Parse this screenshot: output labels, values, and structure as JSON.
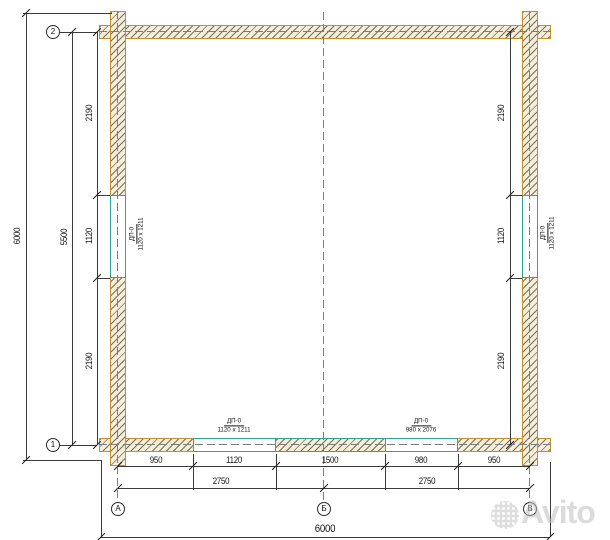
{
  "drawing": {
    "axes": {
      "row_top": "2",
      "row_bottom": "1",
      "col_a": "А",
      "col_b": "Б",
      "col_c": "В"
    },
    "dimensions": {
      "overall_height": "6000",
      "axis_height": "5500",
      "left_segments": [
        "2190",
        "1120",
        "2190"
      ],
      "right_segments": [
        "2190",
        "1120",
        "2190"
      ],
      "bottom_segments": [
        "950",
        "1120",
        "1500",
        "980",
        "950"
      ],
      "bottom_halves": [
        "2750",
        "2750"
      ],
      "overall_width": "6000"
    },
    "openings": {
      "left_window": {
        "tag": "ДП-0",
        "size": "1120 x 1211"
      },
      "right_window": {
        "tag": "ДП-0",
        "size": "1120 x 1211"
      },
      "bottom_door_left": {
        "tag": "ДП-0",
        "size": "1120 x 1211"
      },
      "bottom_door_right": {
        "tag": "ДП-0",
        "size": "980 x 2076"
      }
    }
  },
  "watermark": {
    "brand": "Avito"
  },
  "colors": {
    "wall_border": "#c28f2c",
    "wall_fill": "#f6eed8",
    "opening_line": "#2fa394",
    "dim_line": "#3a3a3a"
  }
}
